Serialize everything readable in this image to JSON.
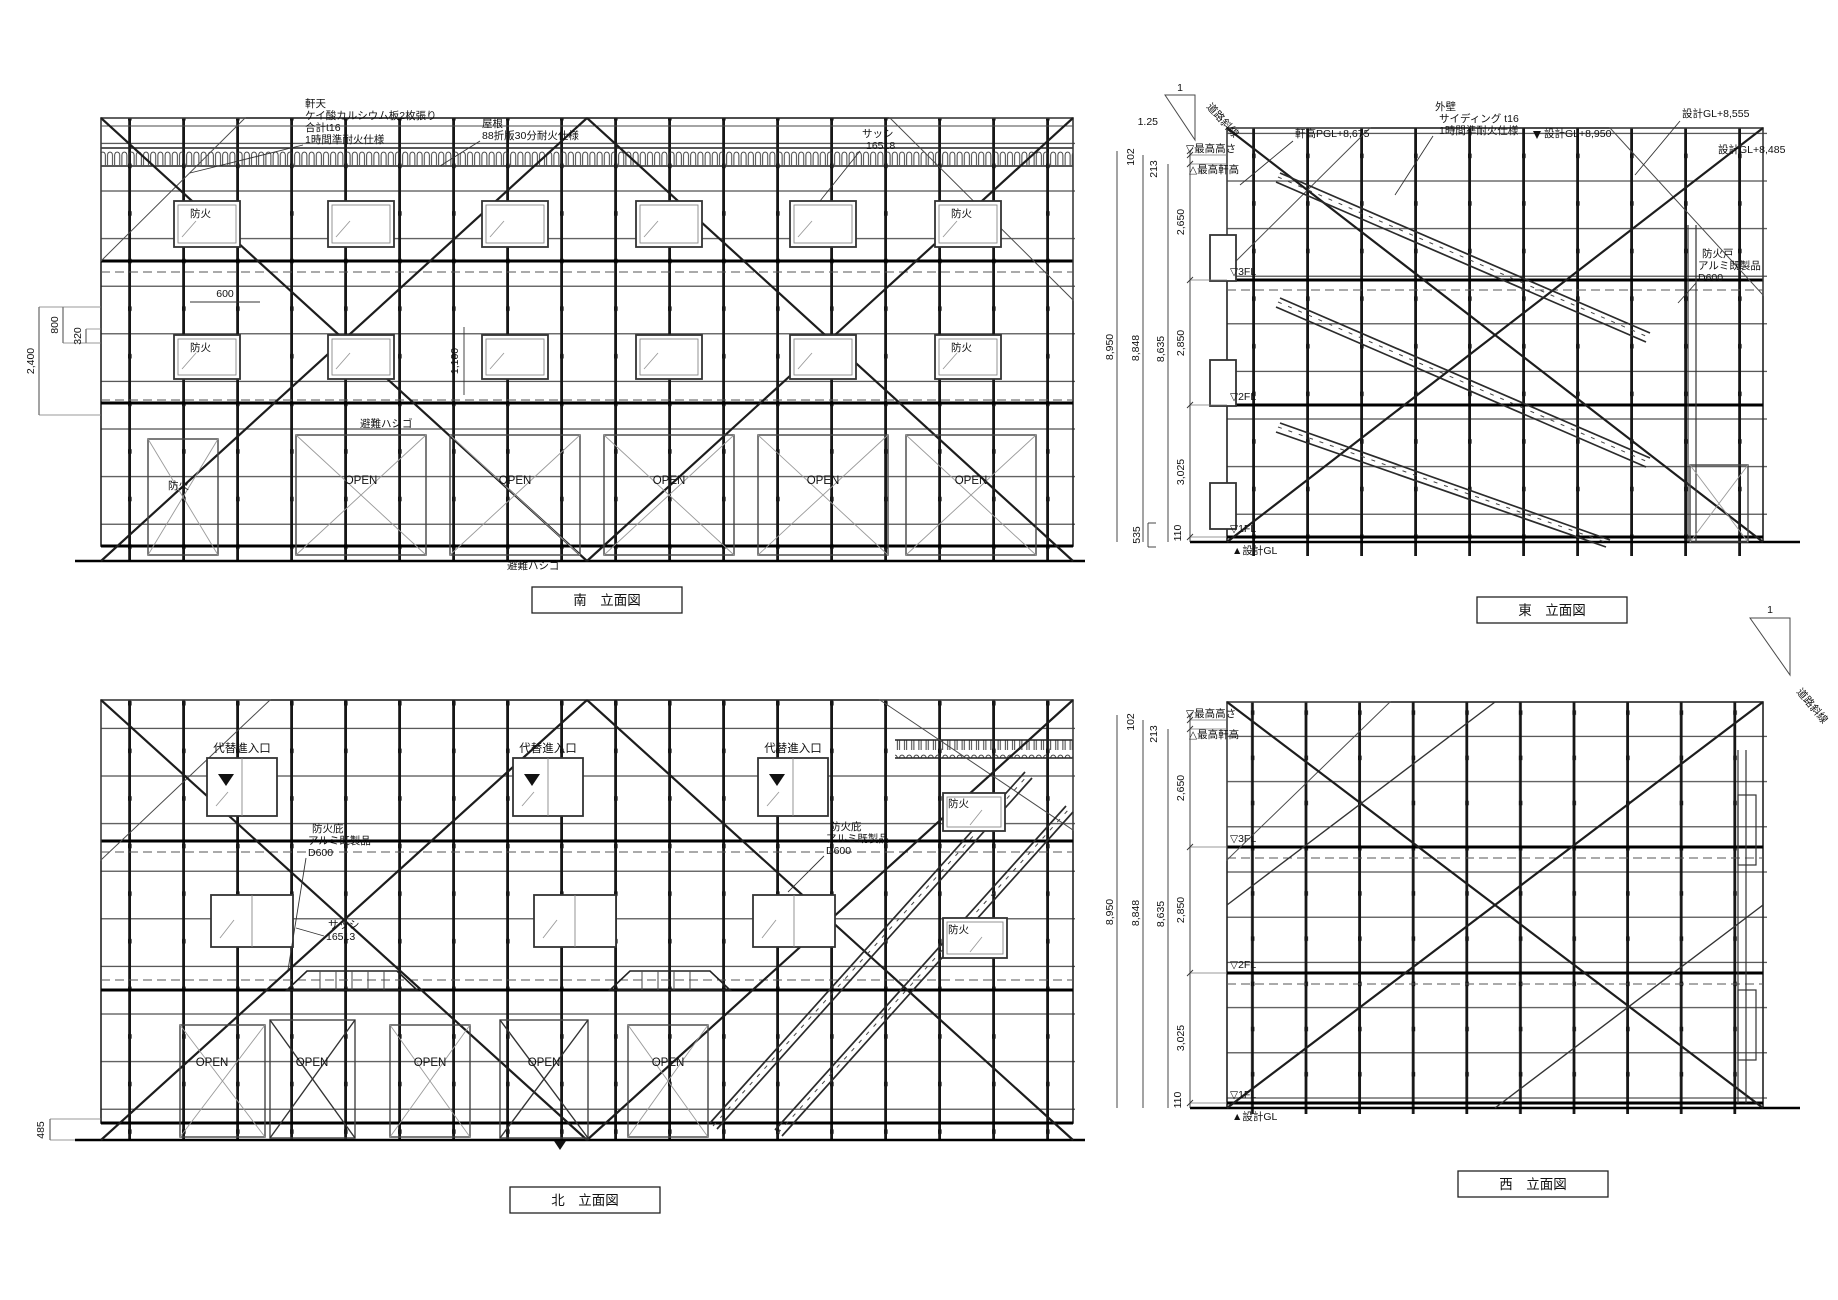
{
  "sheet": {
    "background": "#ffffff",
    "line_color": "#1a1a1a"
  },
  "south": {
    "title": "南　立面図",
    "eaves_note": {
      "l1": "軒天",
      "l2": "ケイ酸カルシウム板2枚張り",
      "l3": "合計t16",
      "l4": "1時間準耐火仕様"
    },
    "roof_note": {
      "l1": "屋根",
      "l2": "88折版30分耐火仕様"
    },
    "sash_note": {
      "l1": "サッシ",
      "l2": "16518"
    },
    "escape_mid": "避難ハシゴ",
    "escape_bottom": "避難ハシゴ",
    "dim_2400": "2,400",
    "dim_800": "800",
    "dim_320": "320",
    "dim_600": "600",
    "dim_1100": "1,100",
    "fire": [
      "防火",
      "防火",
      "防火",
      "防火",
      "防火"
    ],
    "open": [
      "OPEN",
      "OPEN",
      "OPEN",
      "OPEN",
      "OPEN"
    ]
  },
  "east": {
    "title": "東　立面図",
    "slope": {
      "rise": "1",
      "run": "1.25",
      "road": "道路斜線"
    },
    "wall_note": {
      "l1": "外壁",
      "l2": "サイディング t16",
      "l3": "1時間準耐火仕様"
    },
    "eave_level": "軒高PGL+8,675",
    "gl_8950": "設計GL+8,950",
    "gl_8555": "設計GL+8,555",
    "gl_8485": "設計GL+8,485",
    "firedoor_note": {
      "l1": "防火戸",
      "l2": "アルミ既製品",
      "l3": "D600"
    },
    "levels": {
      "max_height": "▽最高高さ",
      "max_eave": "△最高軒高",
      "fl3": "▽3FL",
      "fl2": "▽2FL",
      "fl1": "▽1FL",
      "gl": "▲設計GL"
    },
    "dims": {
      "total": "8,950",
      "sub1": "8,848",
      "sub2": "8,635",
      "seg_top1": "102",
      "seg_top2": "213",
      "seg3": "2,650",
      "seg2": "2,850",
      "seg1": "3,025",
      "seg_base": "535",
      "seg_gl": "110"
    }
  },
  "north": {
    "title": "北　立面図",
    "entry": [
      "代替進入口",
      "代替進入口",
      "代替進入口"
    ],
    "canopy_note1": {
      "l1": "防火庇",
      "l2": "アルミ既製品",
      "l3": "D600"
    },
    "canopy_note2": {
      "l1": "防火庇",
      "l2": "アルミ既製品",
      "l3": "D600"
    },
    "sash_note": {
      "l1": "サッシ",
      "l2": "16513"
    },
    "fire": [
      "防火",
      "防火"
    ],
    "open": [
      "OPEN",
      "OPEN",
      "OPEN",
      "OPEN",
      "OPEN"
    ],
    "dim_485": "485"
  },
  "west": {
    "title": "西　立面図",
    "slope": {
      "rise": "1",
      "road": "道路斜線"
    },
    "levels": {
      "max_height": "▽最高高さ",
      "max_eave": "△最高軒高",
      "fl3": "▽3FL",
      "fl2": "▽2FL",
      "fl1": "▽1FL",
      "gl": "▲設計GL"
    },
    "dims": {
      "total": "8,950",
      "sub1": "8,848",
      "sub2": "8,635",
      "seg_top1": "102",
      "seg_top2": "213",
      "seg3": "2,650",
      "seg2": "2,850",
      "seg1": "3,025",
      "seg_gl": "110"
    }
  }
}
